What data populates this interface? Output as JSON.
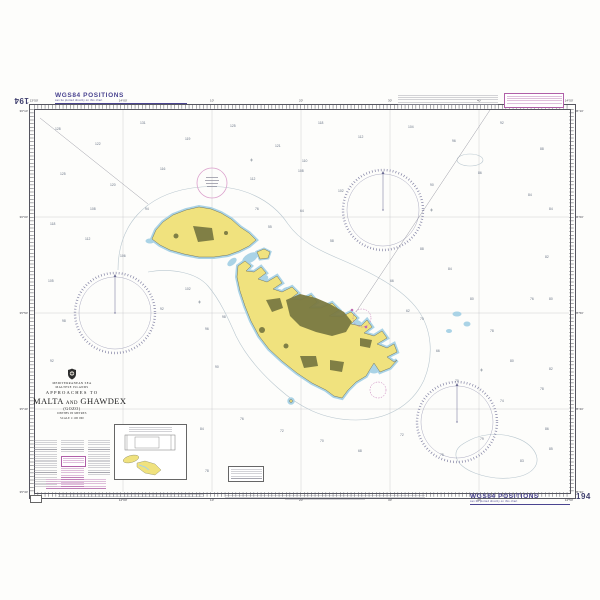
{
  "chart": {
    "number": "194"
  },
  "margin_notes": {
    "wgs84_title": "WGS84 POSITIONS",
    "wgs84_sub": "can be plotted directly on this chart"
  },
  "title_block": {
    "sea": "MEDITERRANEAN SEA",
    "islands": "MALTESE ISLANDS",
    "approaches": "APPROACHES TO",
    "name1": "MALTA",
    "and_word": "AND",
    "name2": "GHAWDEX",
    "subtitle": "(GOZO)",
    "depths": "DEPTHS IN METRES",
    "scale": "SCALE 1:100 000"
  },
  "graticule": {
    "lon_labels": [
      "13°50'",
      "14°00'",
      "10'",
      "20'",
      "30'",
      "40'",
      "14°50'"
    ],
    "lat_labels": [
      "36°10'",
      "36°00'",
      "35°50'",
      "35°40'",
      "35°30'"
    ]
  },
  "colors": {
    "land": "#f0e27e",
    "shallow_water": "#aad3e6",
    "built_up": "#7b7a42",
    "magenta": "#b05fa8",
    "ink_purple": "#4a4490",
    "neatline": "#55555f"
  },
  "soundings": [
    [
      55,
      130,
      "128"
    ],
    [
      95,
      145,
      "122"
    ],
    [
      140,
      124,
      "131"
    ],
    [
      185,
      140,
      "119"
    ],
    [
      230,
      127,
      "125"
    ],
    [
      275,
      147,
      "121"
    ],
    [
      318,
      124,
      "118"
    ],
    [
      358,
      138,
      "112"
    ],
    [
      408,
      128,
      "104"
    ],
    [
      452,
      142,
      "96"
    ],
    [
      500,
      124,
      "92"
    ],
    [
      540,
      150,
      "88"
    ],
    [
      60,
      175,
      "125"
    ],
    [
      110,
      186,
      "120"
    ],
    [
      160,
      170,
      "116"
    ],
    [
      250,
      180,
      "112"
    ],
    [
      298,
      172,
      "108"
    ],
    [
      338,
      192,
      "102"
    ],
    [
      430,
      186,
      "90"
    ],
    [
      478,
      174,
      "86"
    ],
    [
      528,
      196,
      "84"
    ],
    [
      50,
      225,
      "118"
    ],
    [
      85,
      240,
      "112"
    ],
    [
      120,
      257,
      "106"
    ],
    [
      90,
      210,
      "108"
    ],
    [
      145,
      210,
      "94"
    ],
    [
      48,
      282,
      "105"
    ],
    [
      62,
      322,
      "98"
    ],
    [
      50,
      362,
      "92"
    ],
    [
      185,
      290,
      "102"
    ],
    [
      205,
      330,
      "96"
    ],
    [
      222,
      318,
      "98"
    ],
    [
      200,
      430,
      "84"
    ],
    [
      215,
      368,
      "90"
    ],
    [
      160,
      310,
      "92"
    ],
    [
      240,
      420,
      "76"
    ],
    [
      280,
      432,
      "72"
    ],
    [
      320,
      442,
      "70"
    ],
    [
      358,
      452,
      "68"
    ],
    [
      400,
      436,
      "72"
    ],
    [
      440,
      456,
      "75"
    ],
    [
      480,
      440,
      "79"
    ],
    [
      520,
      462,
      "83"
    ],
    [
      545,
      430,
      "86"
    ],
    [
      205,
      472,
      "78"
    ],
    [
      420,
      250,
      "88"
    ],
    [
      448,
      270,
      "84"
    ],
    [
      470,
      300,
      "80"
    ],
    [
      490,
      332,
      "78"
    ],
    [
      510,
      362,
      "80"
    ],
    [
      530,
      300,
      "76"
    ],
    [
      545,
      258,
      "82"
    ],
    [
      420,
      320,
      "70"
    ],
    [
      436,
      352,
      "66"
    ],
    [
      455,
      382,
      "70"
    ],
    [
      500,
      402,
      "74"
    ],
    [
      540,
      390,
      "78"
    ],
    [
      300,
      212,
      "64"
    ],
    [
      330,
      242,
      "58"
    ],
    [
      390,
      282,
      "66"
    ],
    [
      406,
      312,
      "62"
    ],
    [
      302,
      162,
      "110"
    ],
    [
      255,
      210,
      "76"
    ],
    [
      268,
      228,
      "55"
    ],
    [
      549,
      210,
      "84"
    ],
    [
      549,
      300,
      "80"
    ],
    [
      549,
      370,
      "82"
    ],
    [
      549,
      450,
      "85"
    ]
  ]
}
